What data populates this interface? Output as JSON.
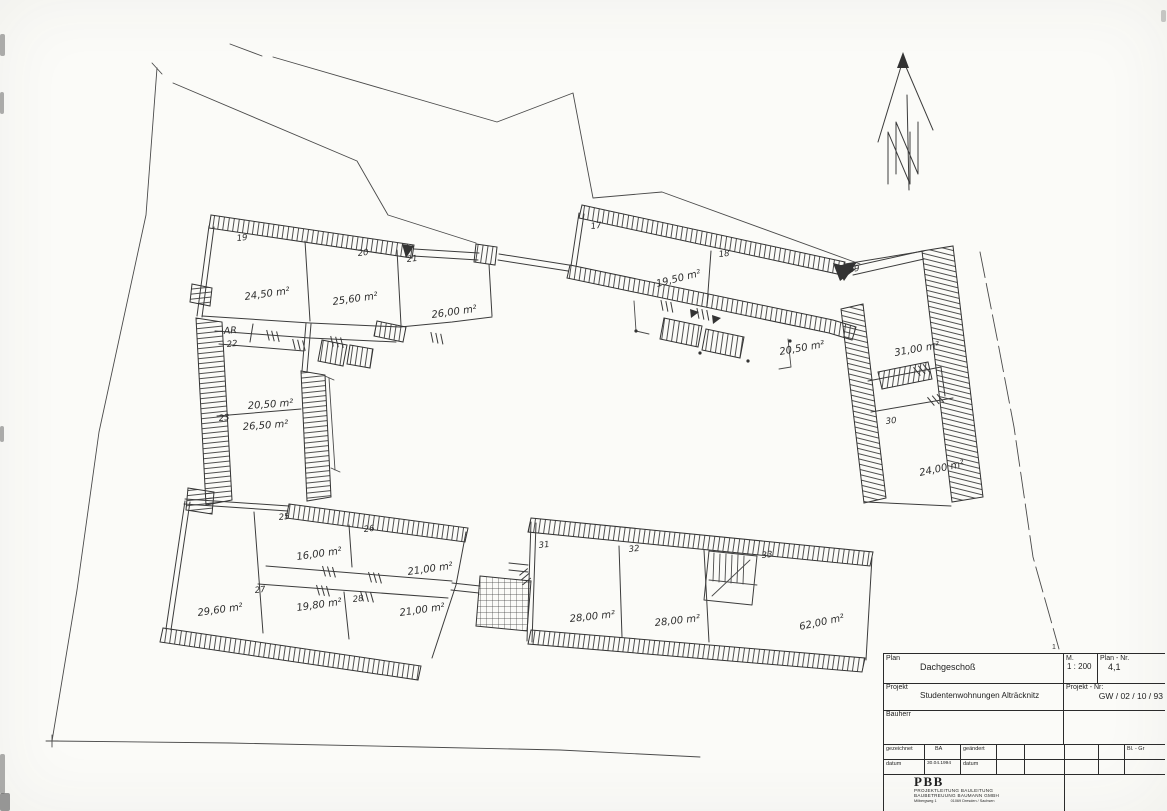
{
  "plan": {
    "annotations": {
      "storage_room": "AR"
    },
    "rooms": [
      {
        "number": "17",
        "area": "19,50 m²"
      },
      {
        "number": "18",
        "area": "20,50 m²"
      },
      {
        "number": "19",
        "area": "24,50 m²"
      },
      {
        "number": "20",
        "area": "25,60 m²"
      },
      {
        "number": "21",
        "area": "26,00 m²"
      },
      {
        "number": "22",
        "area": "20,50 m²"
      },
      {
        "number": "23",
        "area": "26,50 m²"
      },
      {
        "area": "29,60 m²"
      },
      {
        "number": "25",
        "area": "16,00 m²"
      },
      {
        "number": "26",
        "area": "21,00 m²"
      },
      {
        "number": "27",
        "area": "19,80 m²"
      },
      {
        "number": "28",
        "area": "21,00 m²"
      },
      {
        "number": "29",
        "area": "31,00 m²"
      },
      {
        "number": "30",
        "area": "24,00 m²"
      },
      {
        "number": "31",
        "area": "28,00 m²"
      },
      {
        "number": "32",
        "area": "28,00 m²"
      },
      {
        "number": "33",
        "area": "62,00 m²"
      }
    ]
  },
  "title_block": {
    "fold_mark": "1",
    "row_plan": {
      "label": "Plan",
      "value": "Dachgeschoß"
    },
    "scale": {
      "label": "M.",
      "value": "1 : 200"
    },
    "plan_no": {
      "label": "Plan - Nr.",
      "value": "4,1"
    },
    "project": {
      "label": "Projekt",
      "value": "Studentenwohnungen Alträcknitz"
    },
    "project_no": {
      "label": "Projekt - Nr:",
      "value": "GW / 02 / 10 / 93"
    },
    "client": {
      "label": "Bauherr"
    },
    "revision": {
      "drawn_label": "gezeichnet",
      "drawn_by": "BA",
      "changed_label": "geändert",
      "sheet_label": "Bl. - Gr",
      "date_label": "datum",
      "date_value": "30.04.1994",
      "date2_label": "datum"
    },
    "firm": {
      "name": "PBB",
      "line1": "PROJEKTLEITUNG    BAULEITUNG",
      "line2": "BAUBETREUUNG BAUMANN GMBH",
      "address_left": "Milbergweg 1",
      "address_right": "01069 Dresden / Sachsen"
    }
  }
}
